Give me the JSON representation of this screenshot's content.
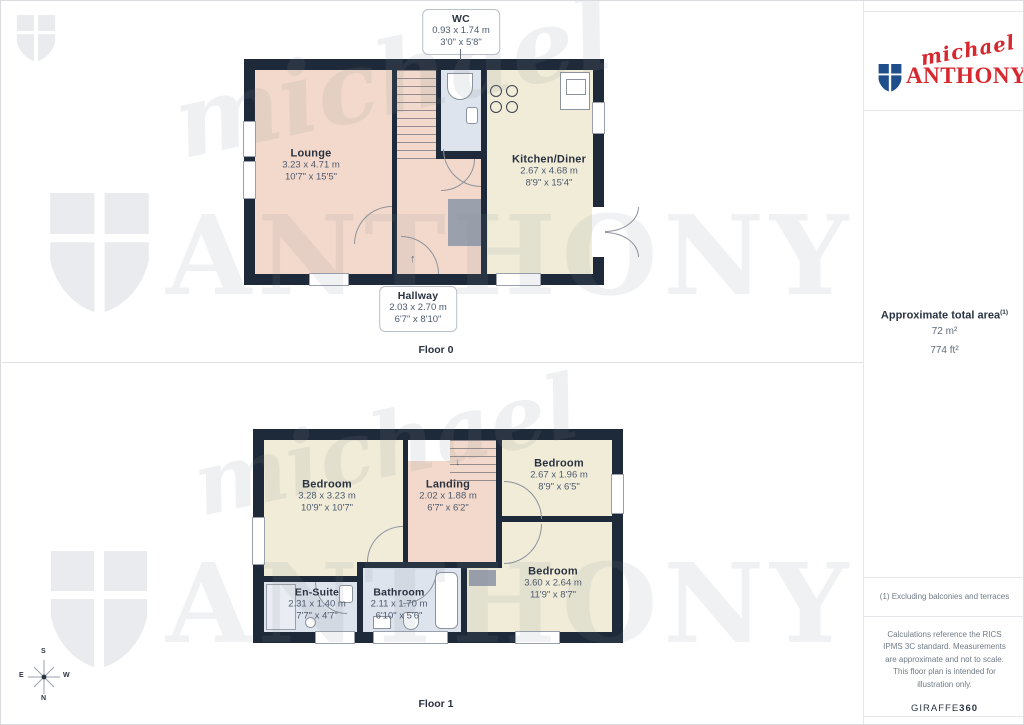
{
  "logo": {
    "script": "michael",
    "name": "ANTHONY"
  },
  "sidebar": {
    "area_title": "Approximate total area",
    "area_superscript": "(1)",
    "area_m2": "72 m²",
    "area_ft2": "774 ft²",
    "footnote": "(1) Excluding balconies and terraces",
    "disclaimer": "Calculations reference the RICS IPMS 3C standard. Measurements are approximate and not to scale. This floor plan is intended for illustration only.",
    "brand": "GIRAFFE",
    "brand_bold": "360"
  },
  "floor0": {
    "label": "Floor 0",
    "rooms": {
      "wc": {
        "name": "WC",
        "metric": "0.93 x 1.74 m",
        "imperial": "3'0\" x 5'8\""
      },
      "lounge": {
        "name": "Lounge",
        "metric": "3.23 x 4.71 m",
        "imperial": "10'7\" x 15'5\""
      },
      "kitchen": {
        "name": "Kitchen/Diner",
        "metric": "2.67 x 4.68 m",
        "imperial": "8'9\" x 15'4\""
      },
      "hallway": {
        "name": "Hallway",
        "metric": "2.03 x 2.70 m",
        "imperial": "6'7\" x 8'10\""
      }
    }
  },
  "floor1": {
    "label": "Floor 1",
    "rooms": {
      "bedroom1": {
        "name": "Bedroom",
        "metric": "3.28 x 3.23 m",
        "imperial": "10'9\" x 10'7\""
      },
      "landing": {
        "name": "Landing",
        "metric": "2.02 x 1.88 m",
        "imperial": "6'7\" x 6'2\""
      },
      "bedroom2": {
        "name": "Bedroom",
        "metric": "2.67 x 1.96 m",
        "imperial": "8'9\" x 6'5\""
      },
      "bedroom3": {
        "name": "Bedroom",
        "metric": "3.60 x 2.64 m",
        "imperial": "11'9\" x 8'7\""
      },
      "ensuite": {
        "name": "En-Suite",
        "metric": "2.31 x 1.40 m",
        "imperial": "7'7\" x 4'7\""
      },
      "bathroom": {
        "name": "Bathroom",
        "metric": "2.11 x 1.70 m",
        "imperial": "6'10\" x 5'6\""
      }
    }
  },
  "compass": {
    "n": "N",
    "s": "S",
    "e": "E",
    "w": "W"
  },
  "icons": {
    "entrance_arrow": "↑",
    "stairs_down_arrow": "↓"
  },
  "colors": {
    "wall": "#1e2939",
    "lounge_fill": "#f3d9cb",
    "kitchen_fill": "#f0ecd8",
    "wetroom_fill": "#dee4ee",
    "brand_red": "#d7282f",
    "brand_blue": "#1e4e8c",
    "label_dark": "#2a3240",
    "dims_gray": "#4d5a6e"
  }
}
